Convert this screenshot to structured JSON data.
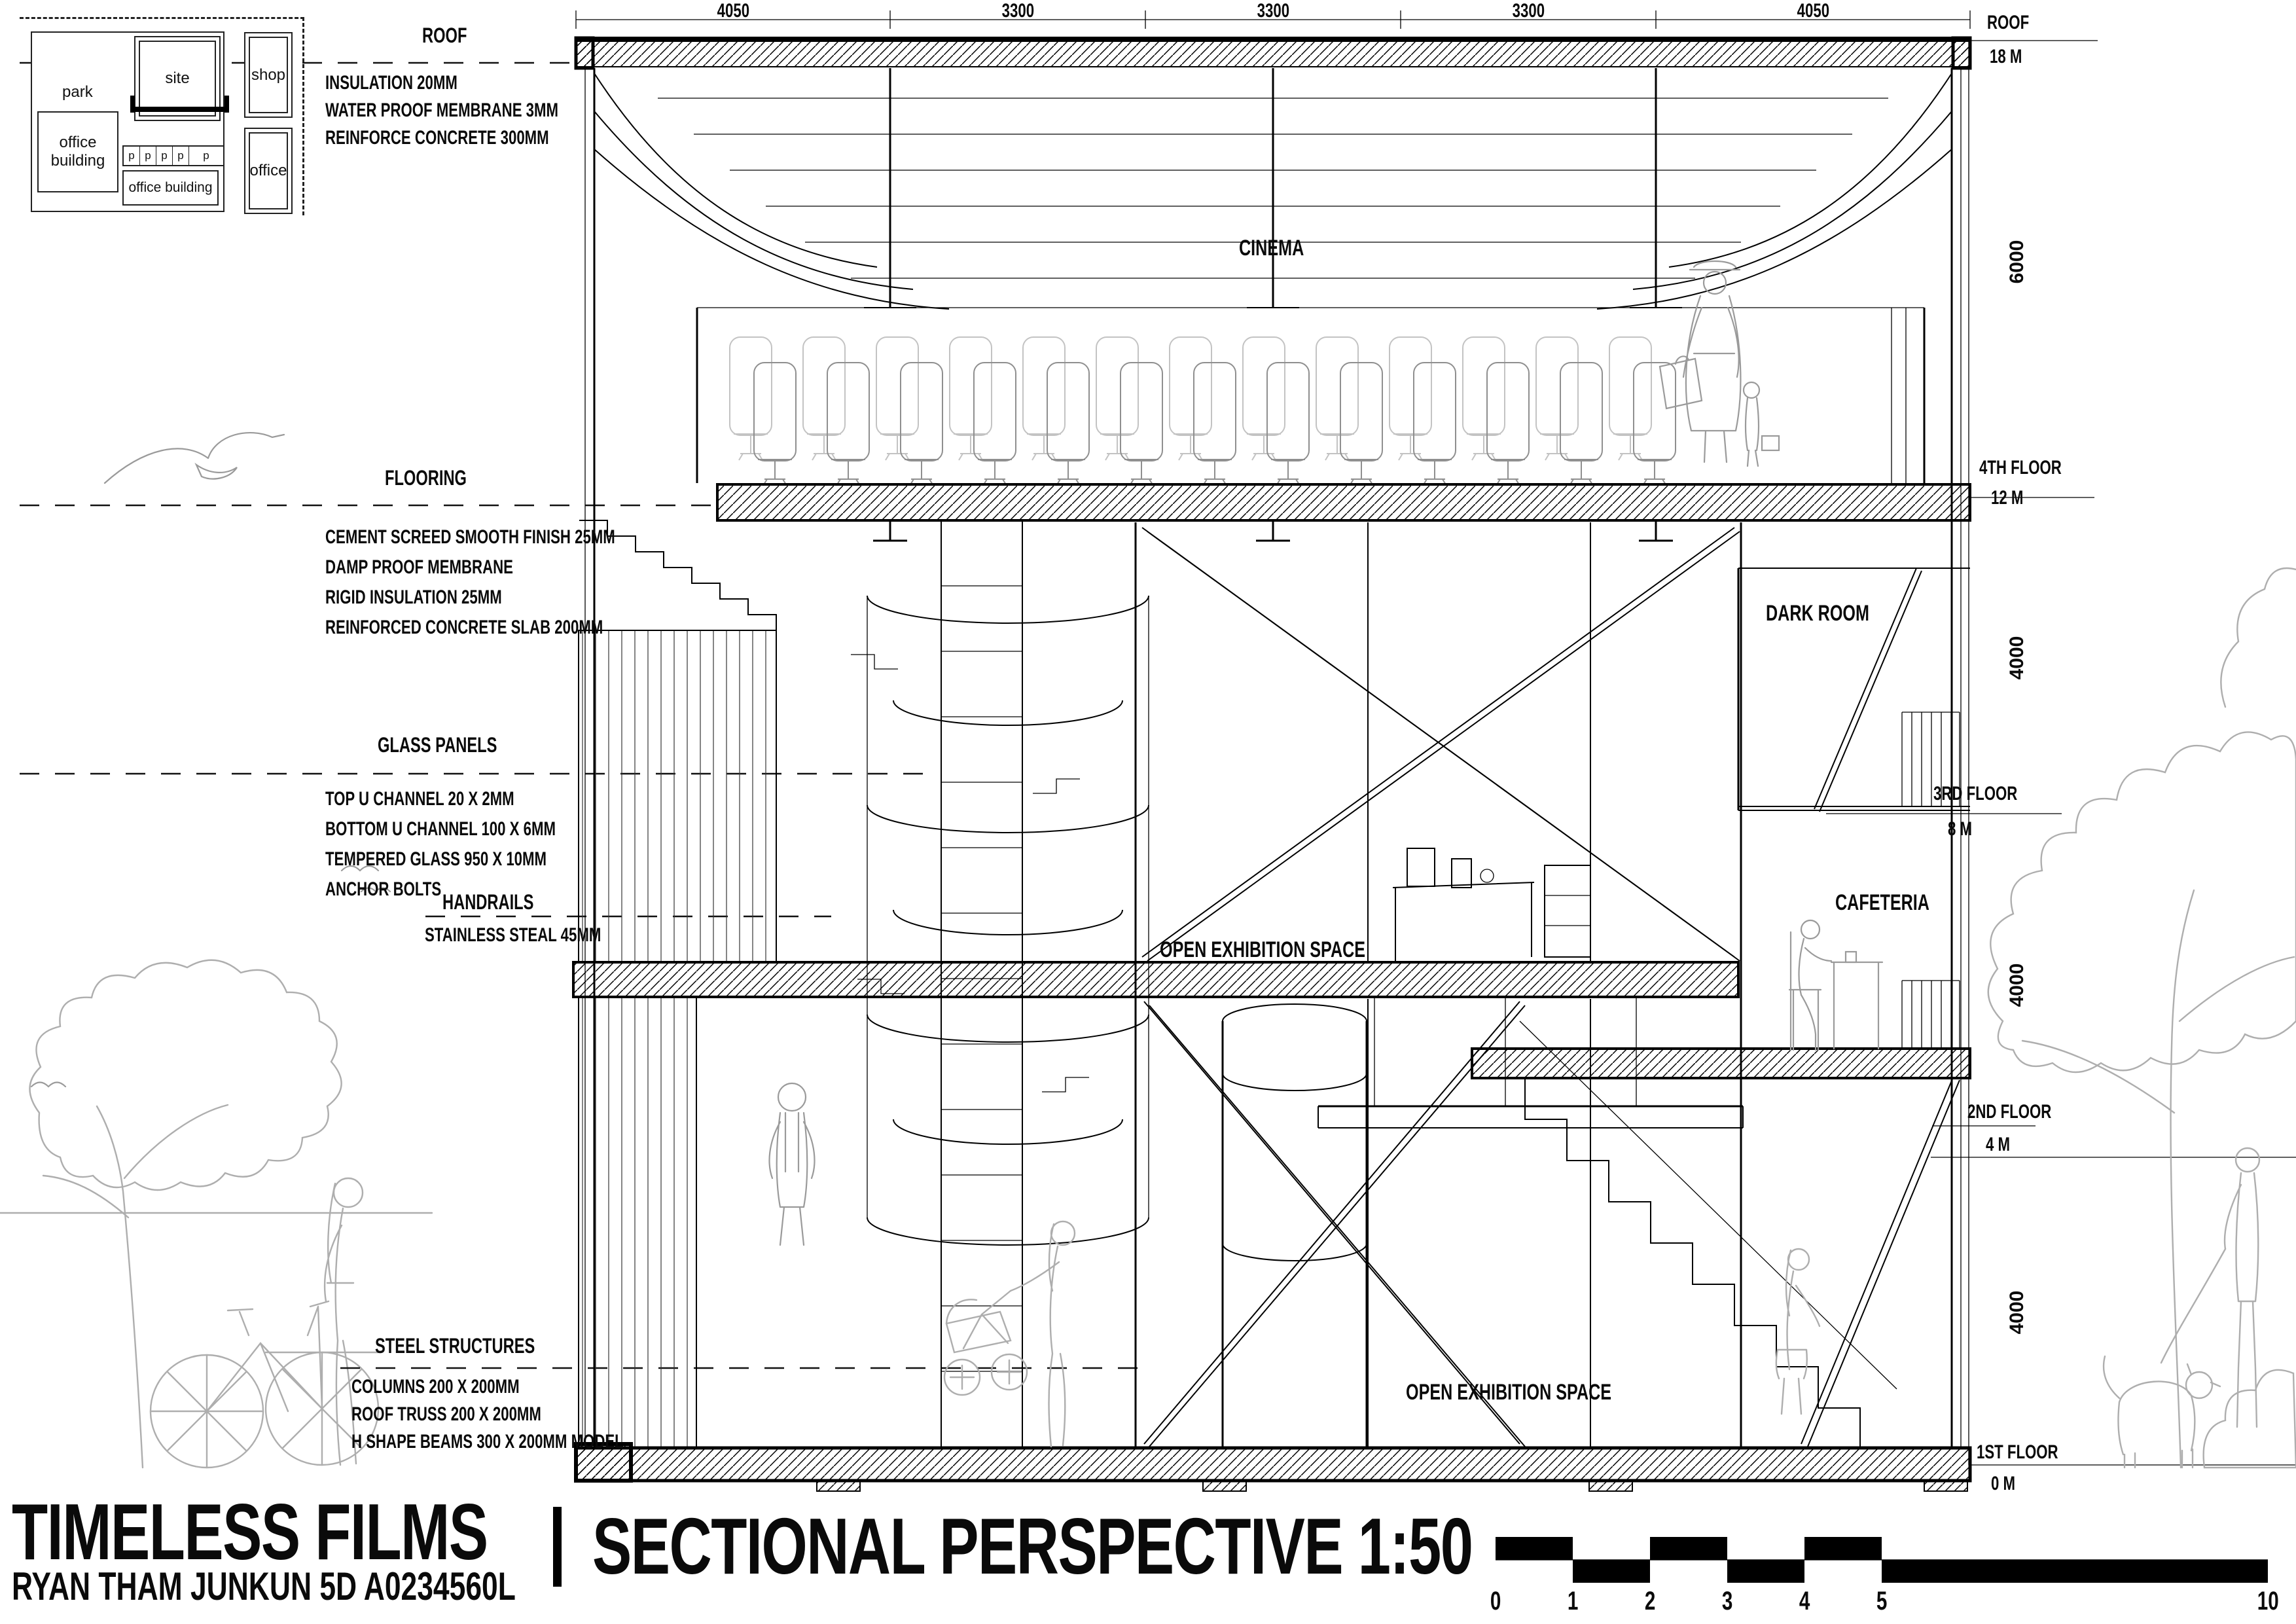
{
  "site_plan": {
    "park": "park",
    "site": "site",
    "shop": "shop",
    "office": "office",
    "office_building_left": "office building",
    "office_building_bottom": "office building",
    "parking_spots": [
      "p",
      "p",
      "p",
      "p",
      "p"
    ]
  },
  "top_dimensions": [
    "4050",
    "3300",
    "3300",
    "3300",
    "4050"
  ],
  "vertical_dimensions": [
    "6000",
    "4000",
    "4000",
    "4000"
  ],
  "annotations": {
    "roof": {
      "title": "ROOF",
      "lines": [
        "INSULATION 20MM",
        "WATER PROOF MEMBRANE 3MM",
        "REINFORCE CONCRETE 300MM"
      ]
    },
    "flooring": {
      "title": "FLOORING",
      "lines": [
        "CEMENT SCREED SMOOTH FINISH 25MM",
        "DAMP PROOF MEMBRANE",
        "RIGID INSULATION 25MM",
        "REINFORCED CONCRETE SLAB 200MM"
      ]
    },
    "glass_panels": {
      "title": "GLASS PANELS",
      "lines": [
        "TOP U CHANNEL 20 X 2MM",
        "BOTTOM U CHANNEL 100 X 6MM",
        "TEMPERED GLASS 950 X 10MM",
        "ANCHOR BOLTS"
      ]
    },
    "handrails": {
      "title": "HANDRAILS",
      "lines": [
        "STAINLESS STEAL 45MM"
      ]
    },
    "steel_structures": {
      "title": "STEEL STRUCTURES",
      "lines": [
        "COLUMNS 200 X 200MM",
        "ROOF TRUSS 200 X 200MM",
        "H SHAPE BEAMS 300 X 200MM MODEL"
      ]
    }
  },
  "levels": {
    "roof": {
      "name": "ROOF",
      "height": "18 M"
    },
    "fourth": {
      "name": "4TH FLOOR",
      "height": "12 M"
    },
    "third": {
      "name": "3RD FLOOR",
      "height": "8 M"
    },
    "second": {
      "name": "2ND FLOOR",
      "height": "4 M"
    },
    "first": {
      "name": "1ST FLOOR",
      "height": "0 M"
    }
  },
  "rooms": {
    "cinema": "CINEMA",
    "dark_room": "DARK ROOM",
    "open_exhibition_upper": "OPEN EXHIBITION SPACE",
    "cafeteria": "CAFETERIA",
    "open_exhibition_lower": "OPEN EXHIBITION SPACE"
  },
  "title_block": {
    "project": "TIMELESS FILMS",
    "author": "RYAN THAM JUNKUN 5D A0234560L",
    "drawing_title": "SECTIONAL PERSPECTIVE 1:50"
  },
  "scale_bar": {
    "labels": [
      "0",
      "1",
      "2",
      "3",
      "4",
      "5"
    ],
    "end_label": "10"
  },
  "colors": {
    "ink": "#000000",
    "background_figures": "#aeaeae",
    "paper": "#ffffff"
  }
}
